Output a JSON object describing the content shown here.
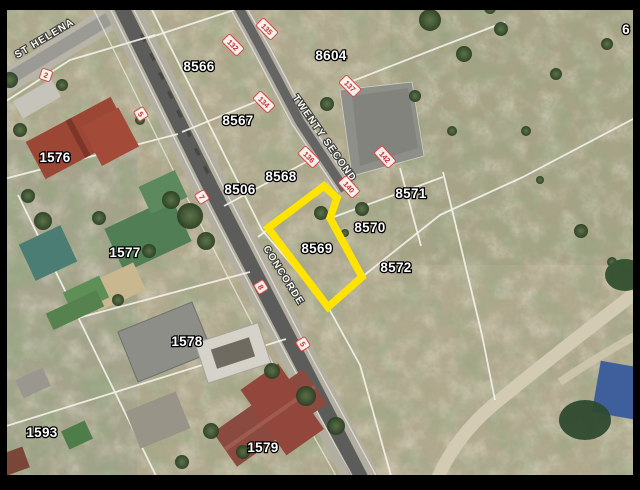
{
  "map": {
    "title": "Cadastral aerial map with highlighted erf 8569",
    "streets": {
      "st_helena": "ST HELENA",
      "twenty_second": "TWENTY SECOND",
      "concorde": "CONCORDE"
    },
    "parcels": {
      "p8566": "8566",
      "p8567": "8567",
      "p8568": "8568",
      "p8569": "8569",
      "p8570": "8570",
      "p8571": "8571",
      "p8572": "8572",
      "p8604": "8604",
      "p8506": "8506",
      "p1576": "1576",
      "p1577": "1577",
      "p1578": "1578",
      "p1579": "1579",
      "p1593": "1593",
      "p6": "6"
    },
    "addresses": {
      "a2": "2",
      "a5w": "5",
      "a7": "7",
      "a132": "132",
      "a135": "135",
      "a134": "134",
      "a137": "137",
      "a136": "136",
      "a140": "140",
      "a142": "142",
      "a8": "8",
      "a5s": "5"
    },
    "highlight": {
      "parcel": "8569",
      "color": "#ffe400"
    },
    "colors": {
      "road_tar": "#5c5c5a",
      "label_halo": "#000000",
      "label_text": "#ffffff",
      "address_red": "#c33030"
    }
  }
}
